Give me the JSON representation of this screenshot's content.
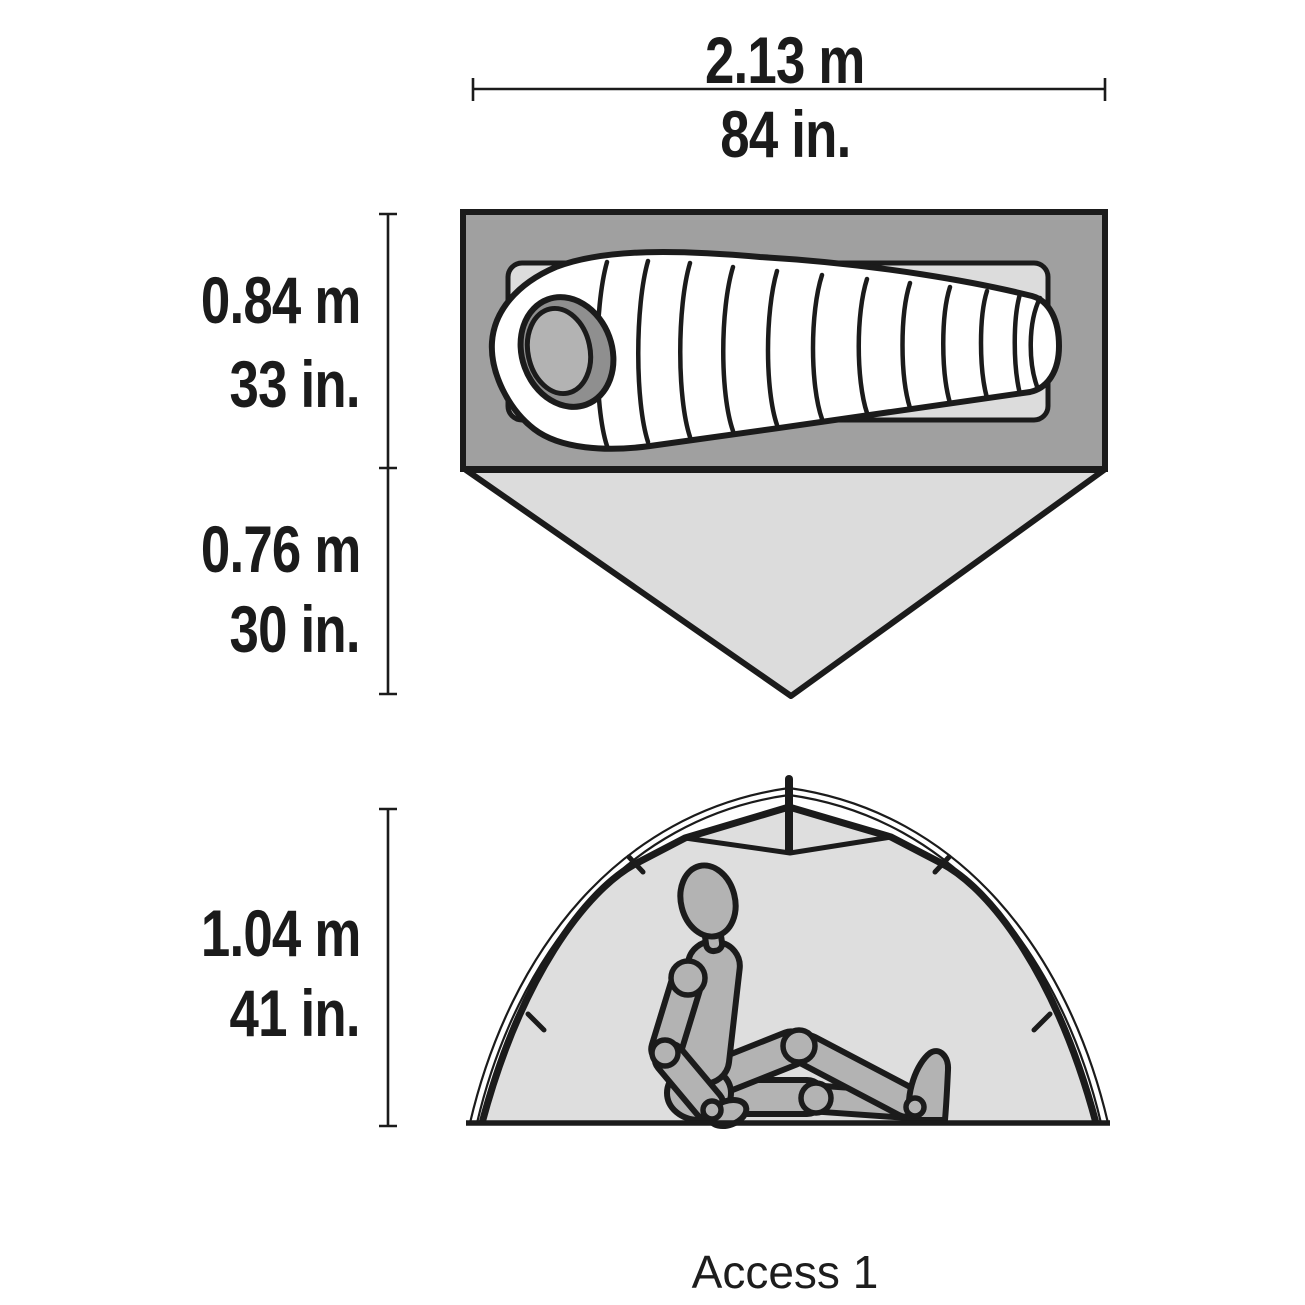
{
  "product": {
    "name": "Access 1"
  },
  "dimensions": {
    "length": {
      "metric": "2.13 m",
      "imperial": "84 in."
    },
    "width": {
      "metric": "0.84 m",
      "imperial": "33 in."
    },
    "vestibule": {
      "metric": "0.76 m",
      "imperial": "30 in."
    },
    "height": {
      "metric": "1.04 m",
      "imperial": "41 in."
    }
  },
  "colors": {
    "bg": "#ffffff",
    "line": "#1b1b1b",
    "floor": "#a0a0a0",
    "pad": "#dcdcdc",
    "vestibule-fill": "#dcdcdc",
    "interior": "#dedede",
    "body-fill": "#b3b3b3",
    "dark-shade": "#8f8f8f",
    "bag-fill": "#ffffff"
  }
}
